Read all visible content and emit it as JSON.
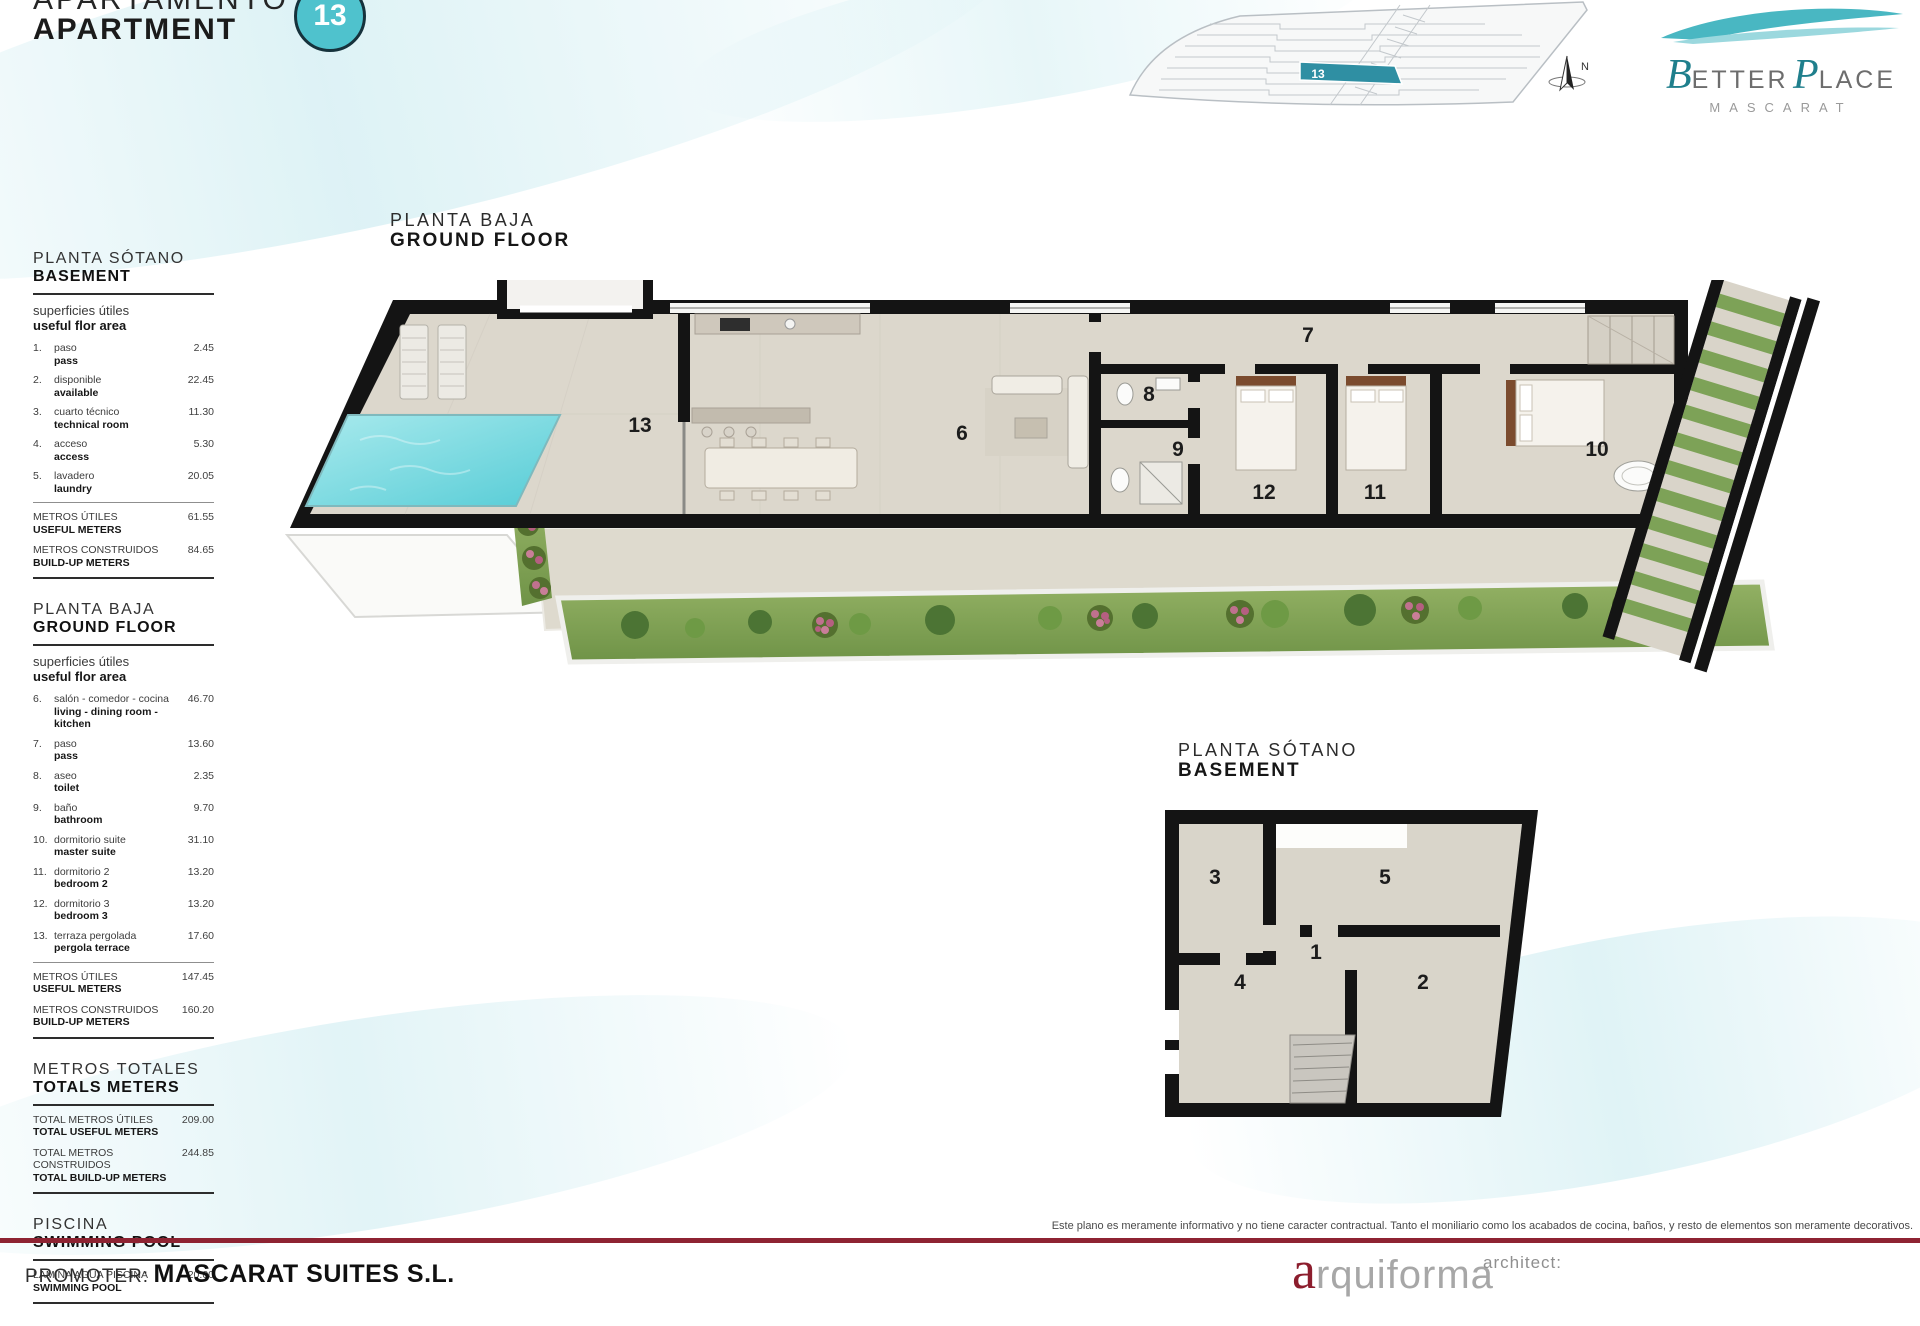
{
  "header": {
    "title_es": "APARTAMENTO",
    "title_en": "APARTMENT",
    "unit": "13"
  },
  "brand": {
    "b_initial": "B",
    "b_rest": "ETTER",
    "p_initial": "P",
    "p_rest": "LACE",
    "sub": "MASCARAT"
  },
  "site_plan": {
    "unit": "13",
    "compass": "N"
  },
  "ground_floor_plan": {
    "title_es": "PLANTA BAJA",
    "title_en": "GROUND FLOOR",
    "rooms": {
      "terrace": "13",
      "living": "6",
      "hall": "7",
      "toilet": "8",
      "bath": "9",
      "bed3": "12",
      "bed2": "11",
      "master": "10"
    }
  },
  "basement_plan": {
    "title_es": "PLANTA SÓTANO",
    "title_en": "BASEMENT",
    "rooms": {
      "tech": "3",
      "laundry": "5",
      "hall": "1",
      "access": "4",
      "available": "2"
    }
  },
  "sidebar": {
    "sections": [
      {
        "title_es": "PLANTA SÓTANO",
        "title_en": "BASEMENT",
        "sub_es": "superficies útiles",
        "sub_en": "useful flor area",
        "rows": [
          {
            "n": "1.",
            "es": "paso",
            "en": "pass",
            "v": "2.45"
          },
          {
            "n": "2.",
            "es": "disponible",
            "en": "available",
            "v": "22.45"
          },
          {
            "n": "3.",
            "es": "cuarto técnico",
            "en": "technical room",
            "v": "11.30"
          },
          {
            "n": "4.",
            "es": "acceso",
            "en": "access",
            "v": "5.30"
          },
          {
            "n": "5.",
            "es": "lavadero",
            "en": "laundry",
            "v": "20.05"
          }
        ],
        "totals": [
          {
            "es": "METROS ÚTILES",
            "en": "USEFUL METERS",
            "v": "61.55"
          },
          {
            "es": "METROS CONSTRUIDOS",
            "en": "BUILD-UP METERS",
            "v": "84.65"
          }
        ]
      },
      {
        "title_es": "PLANTA BAJA",
        "title_en": "GROUND FLOOR",
        "sub_es": "superficies útiles",
        "sub_en": "useful flor area",
        "rows": [
          {
            "n": "6.",
            "es": "salón - comedor - cocina",
            "en": "living - dining room - kitchen",
            "v": "46.70"
          },
          {
            "n": "7.",
            "es": "paso",
            "en": "pass",
            "v": "13.60"
          },
          {
            "n": "8.",
            "es": "aseo",
            "en": "toilet",
            "v": "2.35"
          },
          {
            "n": "9.",
            "es": "baño",
            "en": "bathroom",
            "v": "9.70"
          },
          {
            "n": "10.",
            "es": "dormitorio suite",
            "en": "master suite",
            "v": "31.10"
          },
          {
            "n": "11.",
            "es": "dormitorio 2",
            "en": "bedroom 2",
            "v": "13.20"
          },
          {
            "n": "12.",
            "es": "dormitorio 3",
            "en": "bedroom 3",
            "v": "13.20"
          },
          {
            "n": "13.",
            "es": "terraza pergolada",
            "en": "pergola terrace",
            "v": "17.60"
          }
        ],
        "totals": [
          {
            "es": "METROS ÚTILES",
            "en": "USEFUL METERS",
            "v": "147.45"
          },
          {
            "es": "METROS CONSTRUIDOS",
            "en": "BUILD-UP METERS",
            "v": "160.20"
          }
        ]
      },
      {
        "title_es": "METROS TOTALES",
        "title_en": "TOTALS METERS",
        "totals": [
          {
            "es": "TOTAL METROS ÚTILES",
            "en": "TOTAL USEFUL METERS",
            "v": "209.00"
          },
          {
            "es": "TOTAL METROS CONSTRUIDOS",
            "en": "TOTAL BUILD-UP METERS",
            "v": "244.85"
          }
        ]
      },
      {
        "title_es": "PISCINA",
        "title_en": "SWIMMING POOL",
        "totals": [
          {
            "es": "LÁMINA AGUA PISCINA",
            "en": "SWIMMING POOL",
            "v": "20.00"
          }
        ]
      }
    ]
  },
  "footer": {
    "disclaimer": "Este plano es meramente informativo y no tiene caracter contractual. Tanto el moniliario como los acabados de cocina, baños, y resto de elementos son meramente decorativos.",
    "promoter_label": "PROMOTER:",
    "promoter_name": "MASCARAT SUITES S.L.",
    "studio_initial": "a",
    "studio_rest": "rquiforma",
    "architect_label": "architect:"
  },
  "colors": {
    "accent": "#4fc2cd",
    "brand_teal": "#1f7f8c",
    "line_red": "#8e2332",
    "wall": "#141414",
    "pool": "#7fd7dd",
    "grass": "#7fa050"
  }
}
